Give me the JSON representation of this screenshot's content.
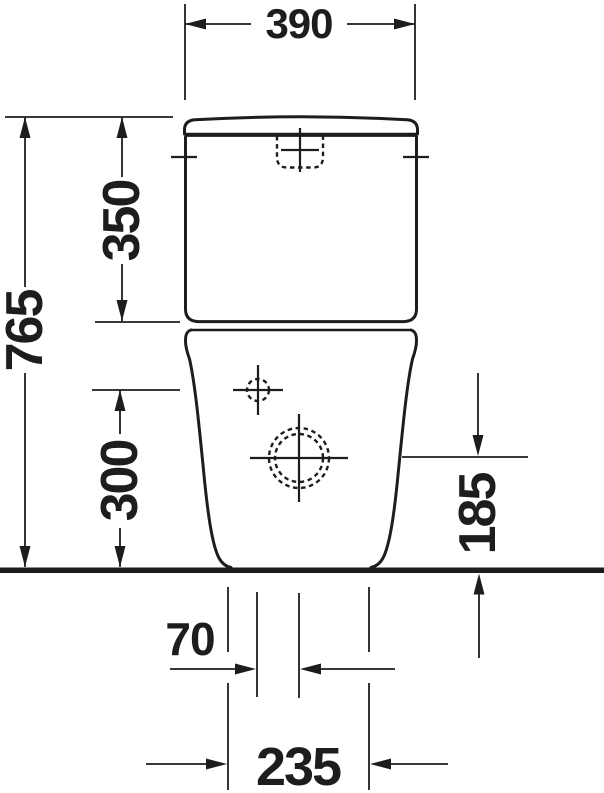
{
  "colors": {
    "line": "#1d1d1b",
    "background": "#ffffff"
  },
  "dimensions": {
    "tank_top_width": "390",
    "total_height": "765",
    "cistern_height": "350",
    "inlet_center_height": "300",
    "outlet_center_height": "185",
    "inlet_outlet_offset": "70",
    "base_width": "235"
  }
}
